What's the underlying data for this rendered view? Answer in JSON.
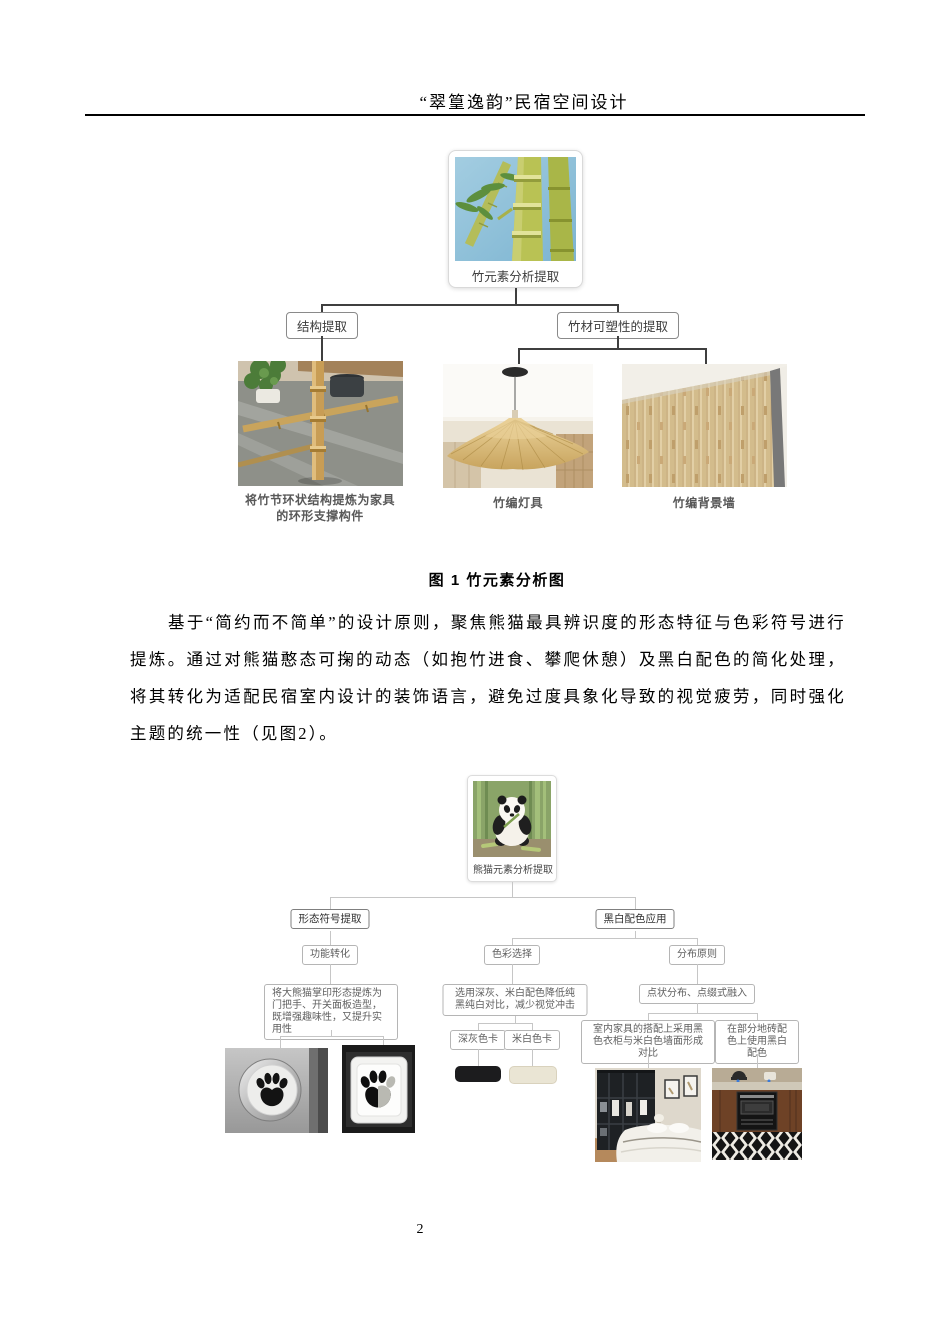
{
  "header": {
    "title": "“翠篁逸韵”民宿空间设计"
  },
  "figure1": {
    "root": {
      "label": "竹元素分析提取",
      "photo": "bamboo-photo"
    },
    "branches": {
      "left": {
        "label": "结构提取"
      },
      "right": {
        "label": "竹材可塑性的提取"
      }
    },
    "items": {
      "furniture": {
        "caption": "将竹节环状结构提炼为家具的环形支撑构件",
        "photo": "bamboo-furniture-photo"
      },
      "lamp": {
        "caption": "竹编灯具",
        "photo": "bamboo-lamp-photo"
      },
      "wall": {
        "caption": "竹编背景墙",
        "photo": "bamboo-wall-photo"
      }
    },
    "caption": "图 1 竹元素分析图"
  },
  "paragraph": "基于“简约而不简单”的设计原则，聚焦熊猫最具辨识度的形态特征与色彩符号进行提炼。通过对熊猫憨态可掬的动态（如抱竹进食、攀爬休憩）及黑白配色的简化处理，将其转化为适配民宿室内设计的装饰语言，避免过度具象化导致的视觉疲劳，同时强化主题的统一性（见图2）。",
  "figure2": {
    "root": {
      "label": "熊猫元素分析提取",
      "photo": "panda-photo"
    },
    "level2": {
      "left": "形态符号提取",
      "right": "黑白配色应用"
    },
    "level3": {
      "function": "功能转化",
      "color": "色彩选择",
      "distribution": "分布原则"
    },
    "level4": {
      "paw": "将大熊猫掌印形态提炼为门把手、开关面板造型，既增强趣味性，又提升实用性",
      "palette": "选用深灰、米白配色降低纯黑纯白对比，减少视觉冲击",
      "dots": "点状分布、点缀式融入"
    },
    "level5": {
      "gray_card": "深灰色卡",
      "white_card": "米白色卡",
      "wardrobe": "室内家具的搭配上采用黑色衣柜与米白色墙面形成对比",
      "tiles": "在部分地砖配色上使用黑白配色"
    },
    "swatches": {
      "dark_gray": "#1c1c1e",
      "off_white": "#eae5d4"
    },
    "photos": [
      "paw-doorknob-photo",
      "paw-switch-photo",
      "bedroom-wardrobe-photo",
      "kitchen-tiles-photo"
    ]
  },
  "colors": {
    "connector_dark": "#3f3f3f",
    "connector_light": "#c6c6c6"
  },
  "page": {
    "number": "2"
  }
}
